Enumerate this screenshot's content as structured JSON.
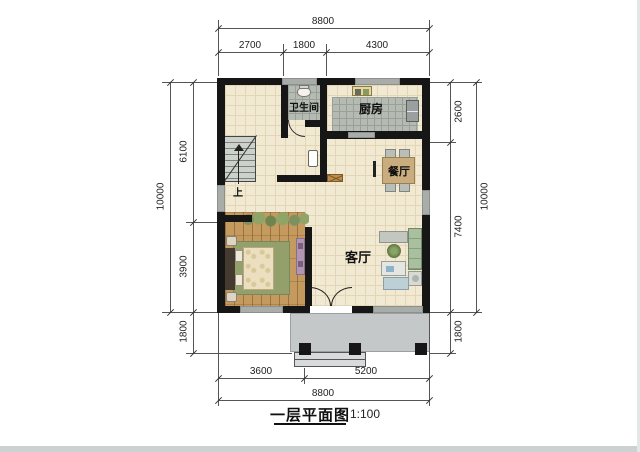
{
  "meta": {
    "drawing_title": "一层平面图",
    "drawing_scale": "1:100"
  },
  "room_labels": {
    "bathroom": "卫生间",
    "kitchen": "厨房",
    "dining": "餐厅",
    "living": "客厅",
    "stair_direction": "上"
  },
  "dimensions": {
    "top": {
      "total": "8800",
      "segments": [
        "2700",
        "1800",
        "4300"
      ]
    },
    "bottom": {
      "total": "8800",
      "segments": [
        "3600",
        "5200"
      ]
    },
    "left": {
      "total": "10000",
      "segments": [
        "6100",
        "3900",
        "1800"
      ]
    },
    "right": {
      "total": "10000",
      "segments": [
        "2600",
        "7400",
        "1800"
      ]
    }
  },
  "colors": {
    "wall": "#161616",
    "floor": "#f2e9d2",
    "tile": "#b5bab2",
    "wood": "#c49a5f",
    "window": "#a9ada9",
    "porch": "#c4c8c8",
    "accent_furniture": "#b195b2",
    "sofa_green": "#a9bf9f"
  }
}
